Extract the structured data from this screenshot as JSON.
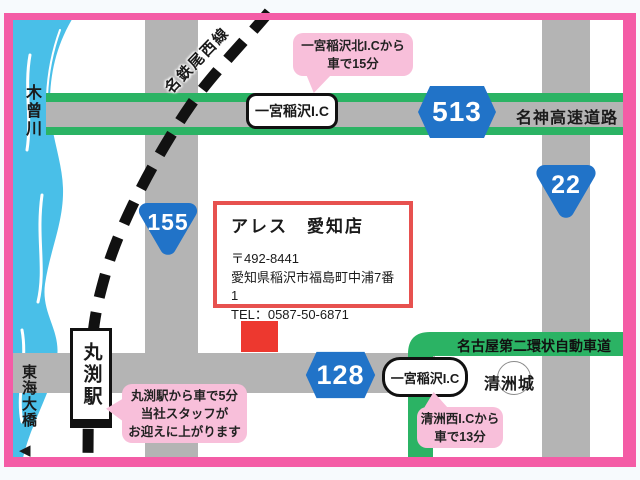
{
  "colors": {
    "frame_pink": "#F45CA6",
    "bubble_pink": "#F8BFDA",
    "road_gray": "#B4B4B4",
    "highway_green": "#2BB364",
    "badge_blue": "#2173C8",
    "river_blue": "#49BFE8",
    "infobox_red": "#E7514F",
    "marker_red": "#ED382F"
  },
  "river": {
    "label": "木曾川"
  },
  "bridge": {
    "label": "東海大橋",
    "arrow": "◀"
  },
  "railway": {
    "label": "名鉄尾西線"
  },
  "station": {
    "label": "丸渕駅"
  },
  "highway": {
    "label": "名神高速道路"
  },
  "ring_road": {
    "label": "名古屋第二環状自動車道"
  },
  "badges": {
    "b513": "513",
    "b22": "22",
    "b155": "155",
    "b128": "128"
  },
  "interchange_top": {
    "label": "一宮稲沢I.C"
  },
  "interchange_bottom": {
    "label": "一宮稲沢I.C"
  },
  "castle": {
    "label": "清洲城"
  },
  "info_box": {
    "title": "アレス　愛知店",
    "postal": "〒492-8441",
    "address": "愛知県稲沢市福島町中浦7番1",
    "tel": "TEL：0587-50-6871"
  },
  "bubbles": {
    "north_ic": {
      "line1": "一宮稲沢北I.Cから",
      "line2": "車で15分"
    },
    "station": {
      "line1": "丸渕駅から車で5分",
      "line2": "当社スタッフが",
      "line3": "お迎えに上がります"
    },
    "west_ic": {
      "line1": "清洲西I.Cから",
      "line2": "車で13分"
    }
  }
}
